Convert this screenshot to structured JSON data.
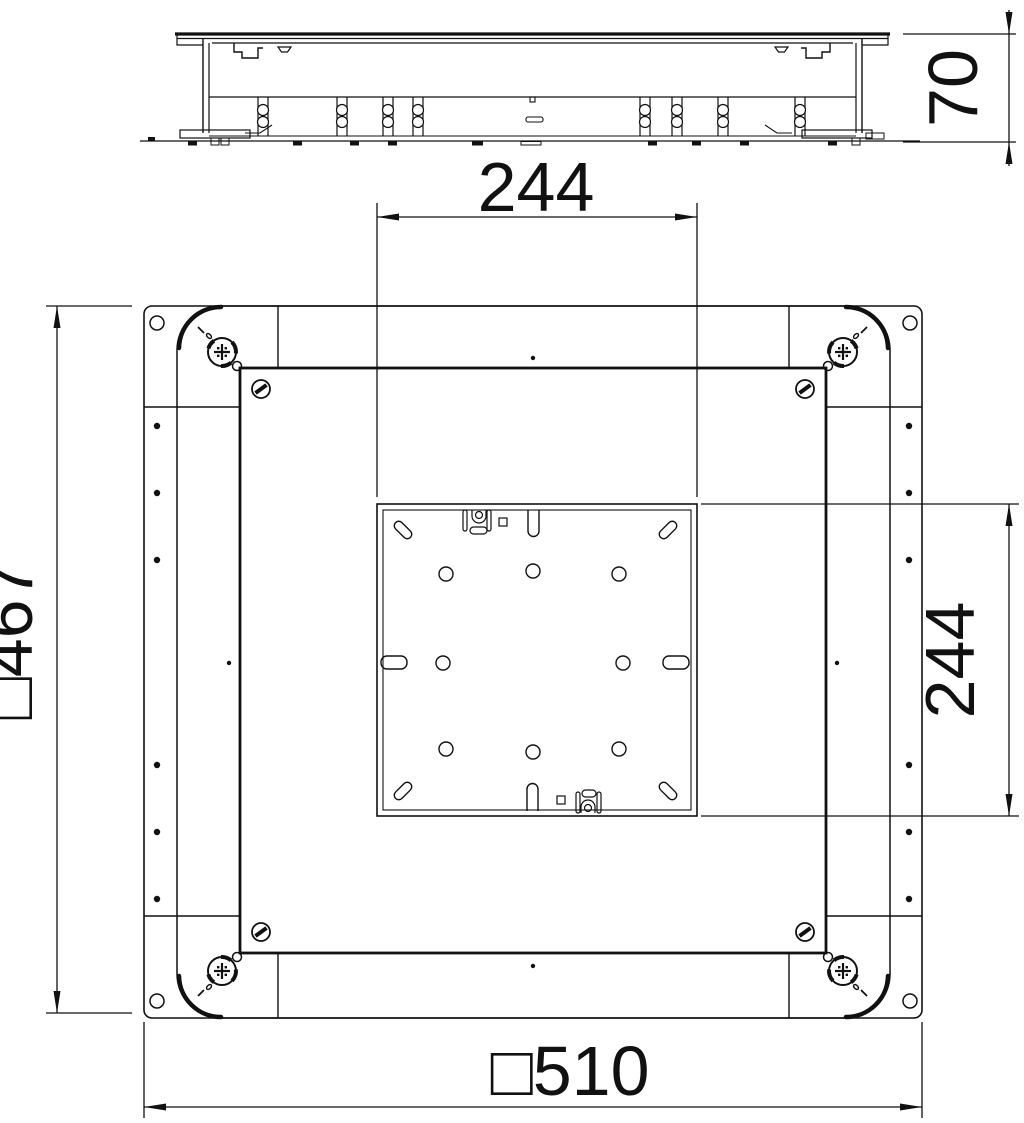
{
  "meta": {
    "drawing_kind": "underfloor junction box technical drawing",
    "line_color": "#111111",
    "background_color": "#ffffff"
  },
  "dimensions": {
    "side_height": "70",
    "inner_width": "244",
    "inner_height": "244",
    "frame_size": "□467",
    "overall_size": "□510"
  }
}
